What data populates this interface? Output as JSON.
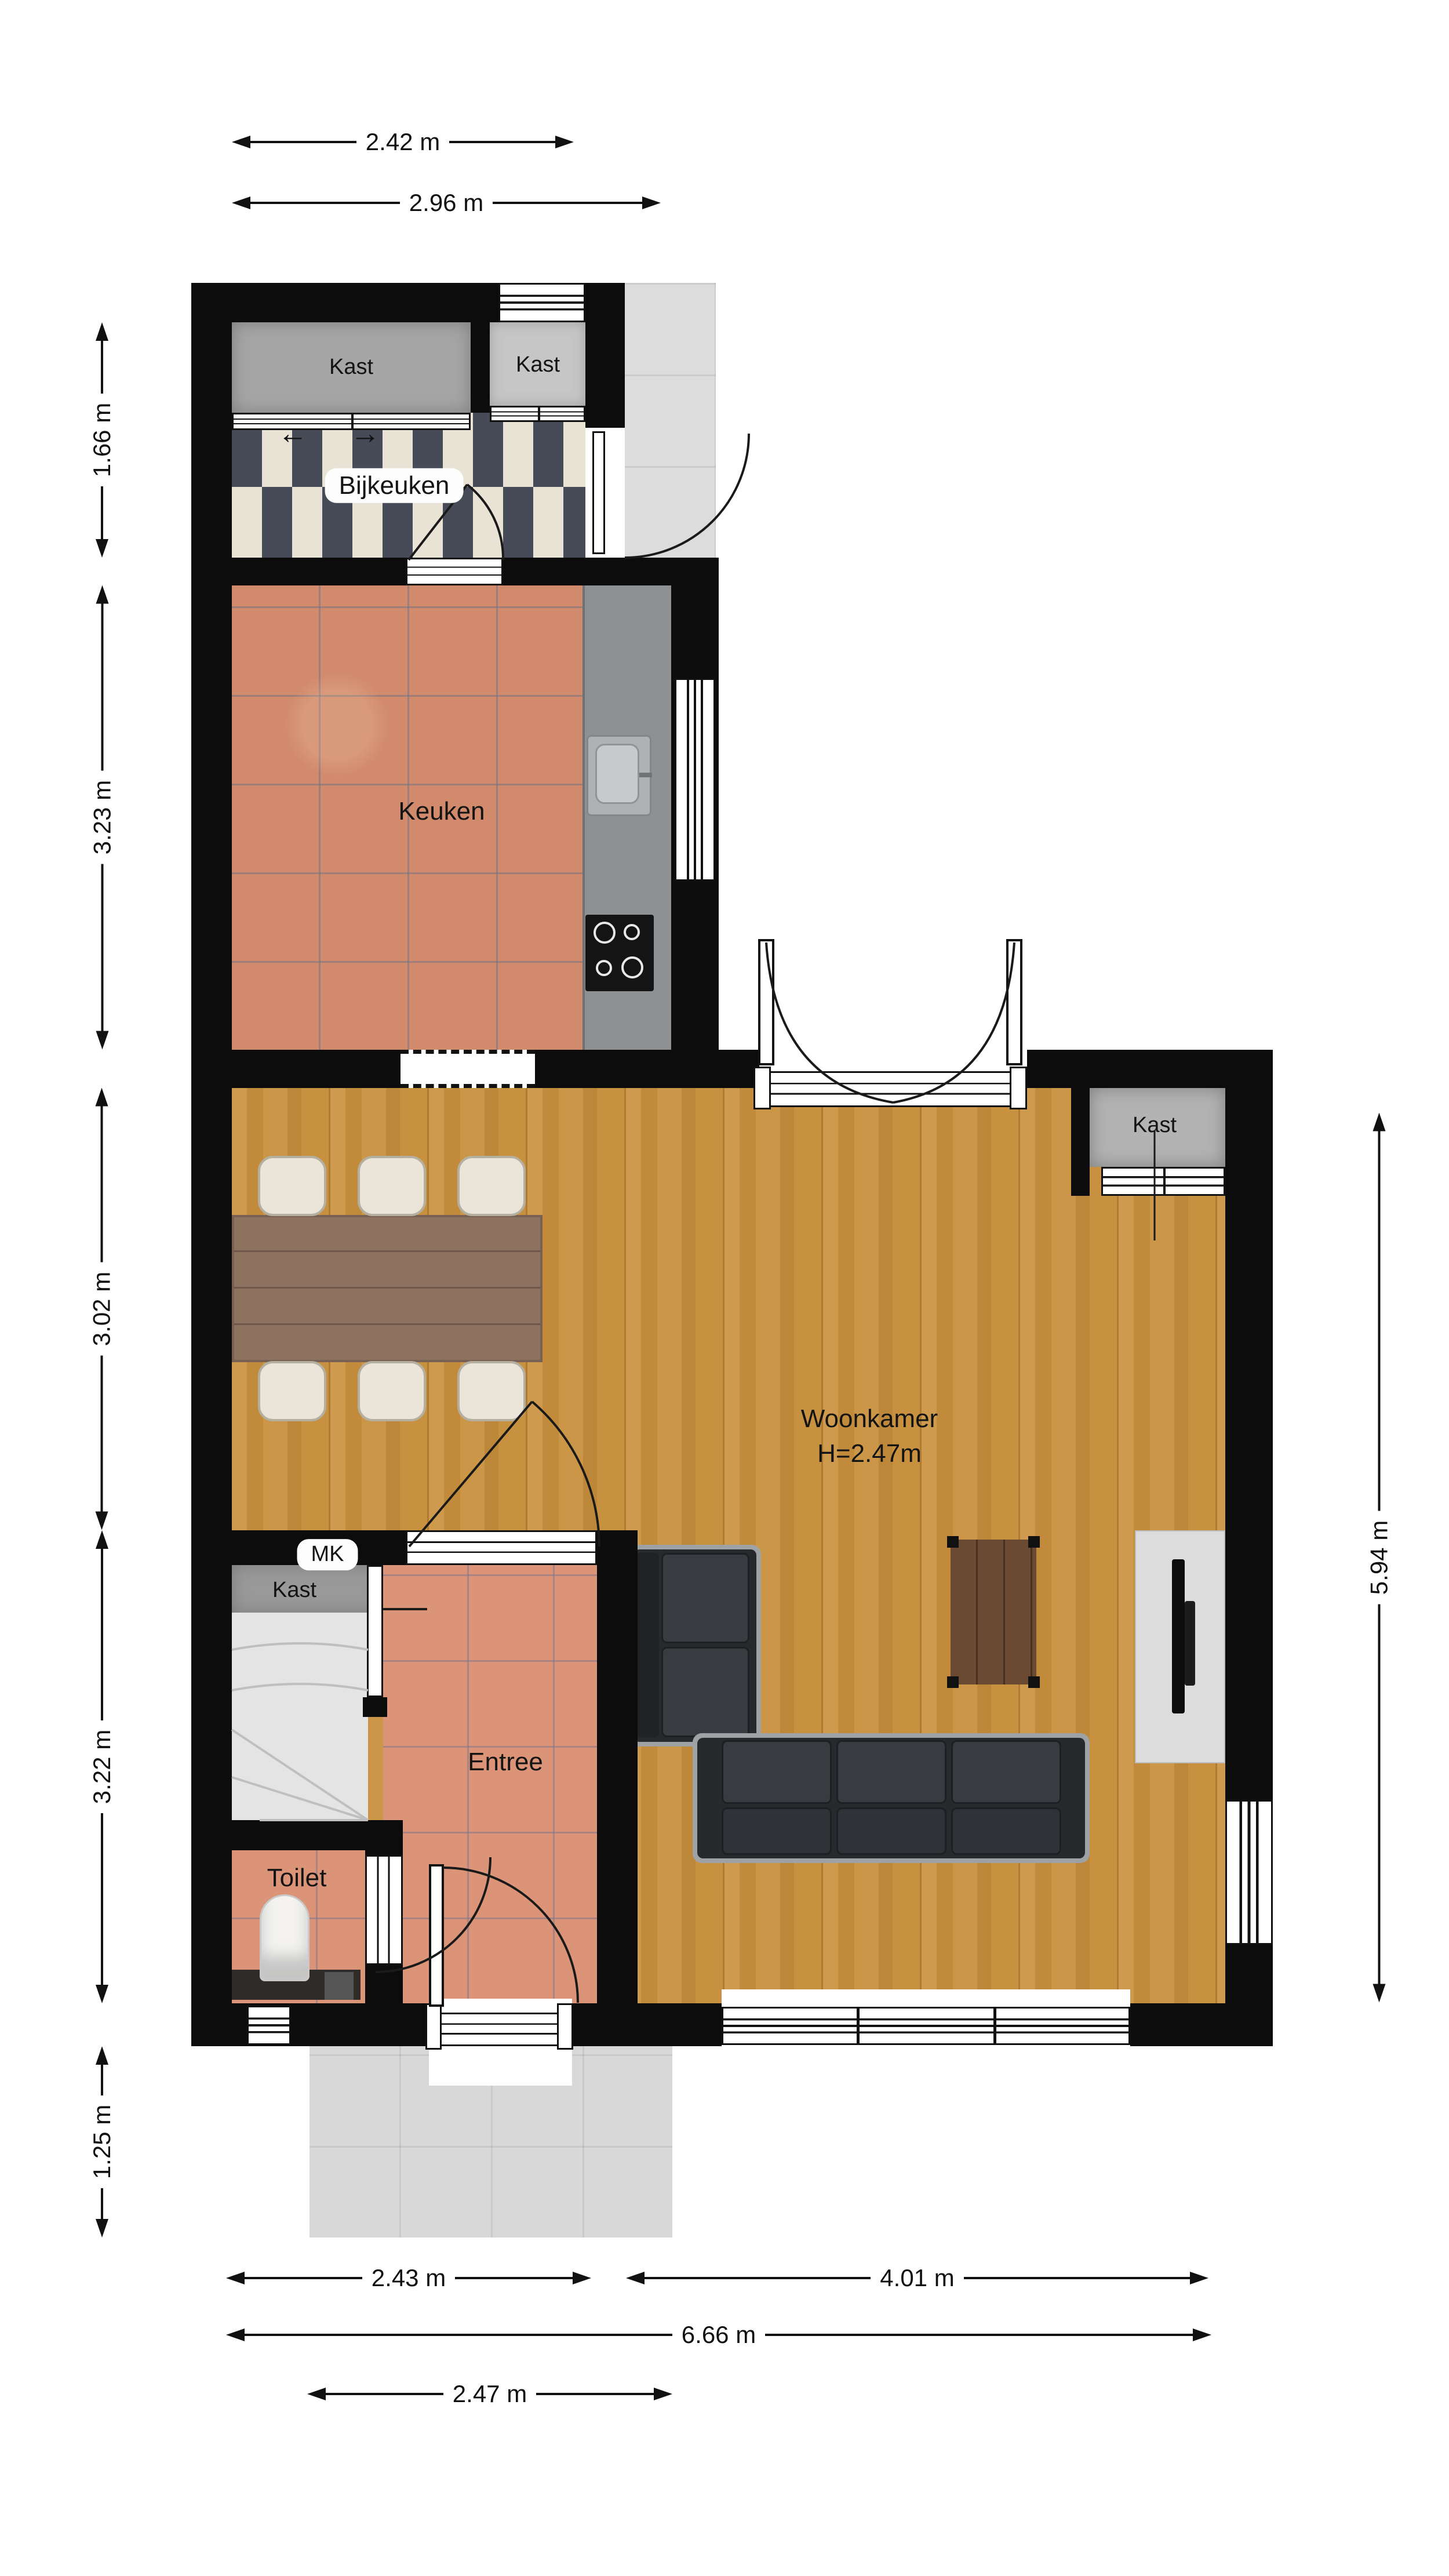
{
  "plan_title": "floor-plan-ground-floor",
  "rooms": {
    "bijkeuken": {
      "label": "Bijkeuken"
    },
    "keuken": {
      "label": "Keuken"
    },
    "woonkamer": {
      "label": "Woonkamer",
      "height_note": "H=2.47m"
    },
    "entree": {
      "label": "Entree"
    },
    "toilet": {
      "label": "Toilet"
    },
    "mk": {
      "label": "MK"
    },
    "kast1": {
      "label": "Kast"
    },
    "kast2": {
      "label": "Kast"
    },
    "kast3": {
      "label": "Kast"
    },
    "kast4": {
      "label": "Kast"
    }
  },
  "icons": {
    "slide_left": "←",
    "slide_right": "→"
  },
  "dimensions": {
    "top": [
      {
        "label": "2.42 m"
      },
      {
        "label": "2.96 m"
      }
    ],
    "left": [
      {
        "label": "1.66 m"
      },
      {
        "label": "3.23 m"
      },
      {
        "label": "3.02 m"
      },
      {
        "label": "3.22 m"
      },
      {
        "label": "1.25 m"
      }
    ],
    "right": [
      {
        "label": "5.94 m"
      }
    ],
    "bottom": [
      {
        "label": "2.43 m"
      },
      {
        "label": "4.01 m"
      },
      {
        "label": "6.66 m"
      },
      {
        "label": "2.47 m"
      }
    ]
  },
  "colors": {
    "wall": "#0c0c0c",
    "wood_floor": "#c8913f",
    "kitchen_tile": "#d18a6c",
    "entry_tile": "#dc9478",
    "checker_dark": "#474b58",
    "checker_light": "#e9e3d6",
    "patio": "#dcdcdc",
    "counter": "#8d9194",
    "sofa": "#27292d",
    "coffee_table": "#6a4a33",
    "dining_table": "#8d7260"
  }
}
